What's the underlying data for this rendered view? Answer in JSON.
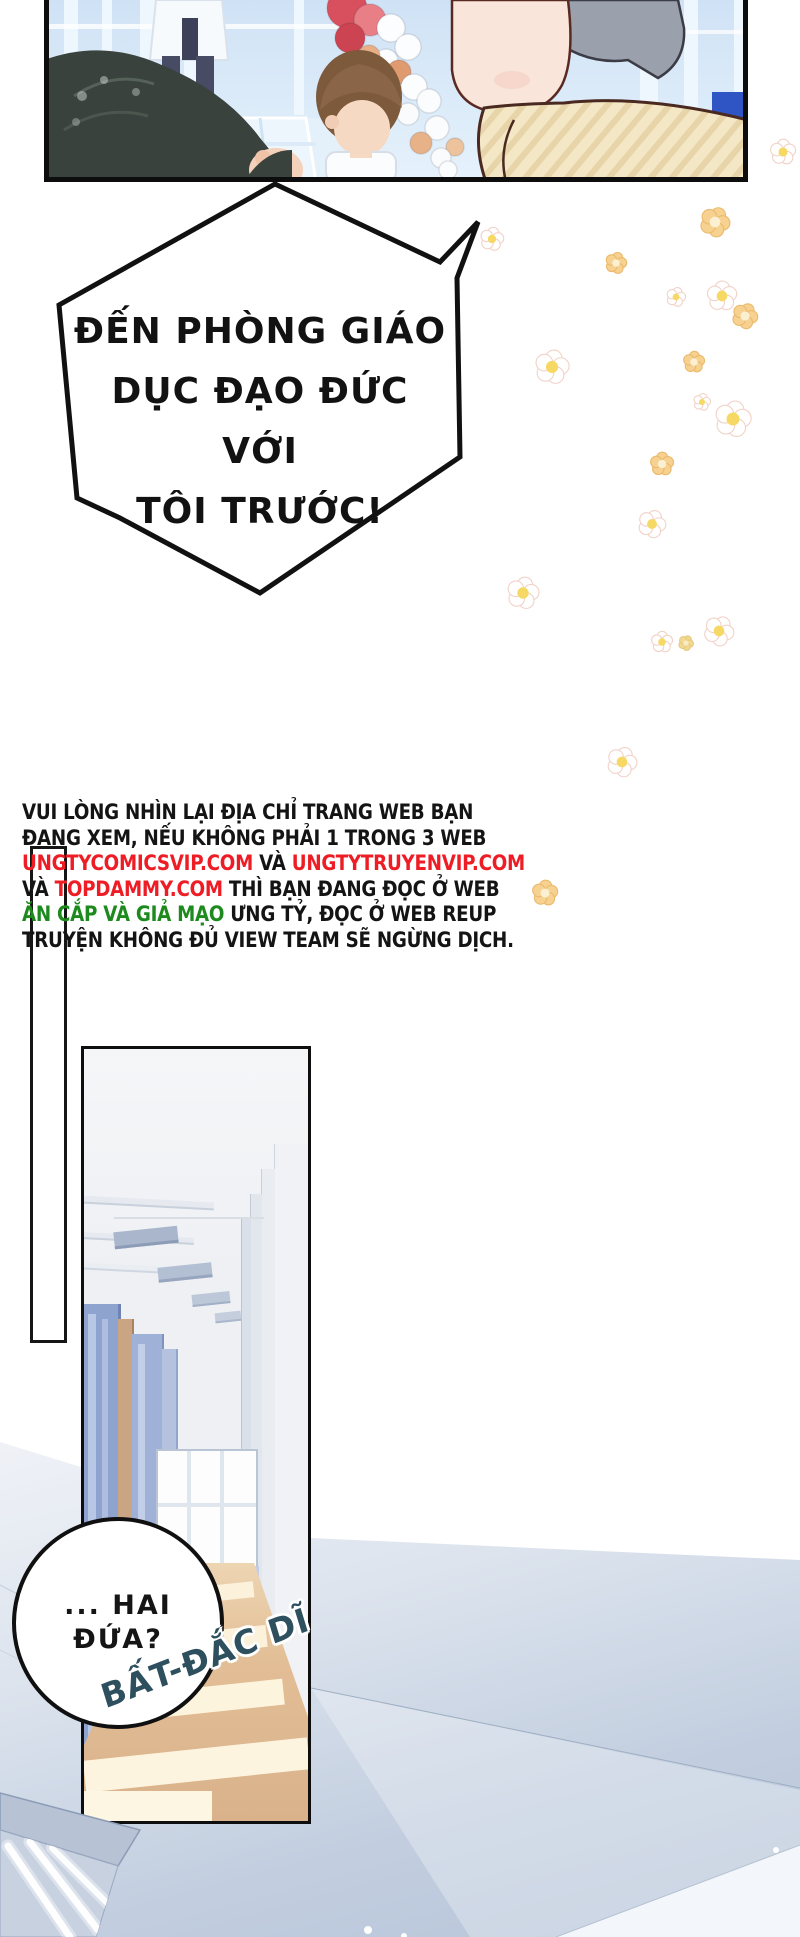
{
  "page": {
    "kind": "manhua-webtoon-page",
    "background": "#ffffff"
  },
  "top_panel": {
    "scene": "school hall interior with balloon garland, teacher on podium, children watching",
    "colors": {
      "wall_blue": "#d7e7f7",
      "platform": "#ecf5fc",
      "coat": "#f7fafc",
      "pants": "#474b63",
      "child_hair": "#7d5a3c",
      "skin": "#f6d9c3",
      "big_face": "#f9e5da",
      "big_hair": "#9aa1ad",
      "shirt": "#f4e7c6",
      "shirt_stripe": "#e7d4a8",
      "dark_hair": "#39423c",
      "blue_board": "#2f55c4"
    },
    "balloons": [
      [
        347,
        8,
        20,
        "#d8505e"
      ],
      [
        370,
        20,
        16,
        "#e87e86"
      ],
      [
        350,
        38,
        15,
        "#cc4351"
      ],
      [
        391,
        28,
        14,
        "#fcfdfe"
      ],
      [
        408,
        47,
        13,
        "#fcfdfe"
      ],
      [
        386,
        61,
        12,
        "#fafcfd"
      ],
      [
        369,
        56,
        11,
        "#eaae86"
      ],
      [
        399,
        72,
        12,
        "#e09a70"
      ],
      [
        414,
        87,
        13,
        "#fcfdfe"
      ],
      [
        429,
        101,
        12,
        "#fafcfd"
      ],
      [
        408,
        114,
        11,
        "#f9fbfc"
      ],
      [
        437,
        128,
        12,
        "#fbfcfe"
      ],
      [
        421,
        143,
        11,
        "#e8b288"
      ],
      [
        455,
        147,
        9,
        "#ecc39c"
      ],
      [
        441,
        158,
        10,
        "#fafbfd"
      ],
      [
        448,
        170,
        9,
        "#fbfcfe"
      ]
    ]
  },
  "speech_bubble": {
    "lines": [
      "ĐẾN PHÒNG GIÁO",
      "DỤC ĐẠO ĐỨC VỚI",
      "TÔI TRƯỚC!"
    ],
    "text_color": "#121212",
    "outline_color": "#111111",
    "points": "275,184 440,262 478,222 457,278 460,457 260,593 120,518 77,498 59,305"
  },
  "notice": {
    "colors": {
      "ink": "#141414",
      "red": "#ee1c25",
      "green": "#1d8a1d"
    },
    "lines": [
      [
        {
          "t": "VUI LÒNG NHÌN LẠI ĐỊA CHỈ TRANG WEB BẠN",
          "c": "ink"
        }
      ],
      [
        {
          "t": "ĐANG XEM, NẾU KHÔNG PHẢI 1 TRONG 3 WEB",
          "c": "ink"
        }
      ],
      [
        {
          "t": "UNGTYCOMICSVIP.COM",
          "c": "red"
        },
        {
          "t": " VÀ ",
          "c": "ink"
        },
        {
          "t": "UNGTYTRUYENVIP.COM",
          "c": "red"
        }
      ],
      [
        {
          "t": "VÀ ",
          "c": "ink"
        },
        {
          "t": "TOPDAMMY.COM",
          "c": "red"
        },
        {
          "t": " THÌ BẠN ĐANG ĐỌC Ở WEB",
          "c": "ink"
        }
      ],
      [
        {
          "t": "ĂN CẮP VÀ GIẢ MẠO",
          "c": "green"
        },
        {
          "t": " ƯNG TỶ, ĐỌC Ở WEB REUP",
          "c": "ink"
        }
      ],
      [
        {
          "t": "TRUYỆN KHÔNG ĐỦ VIEW TEAM SẼ NGỪNG DỊCH.",
          "c": "ink"
        }
      ]
    ]
  },
  "flowers": {
    "palette": {
      "white_petal": "#ffffff",
      "white_edge": "#f1d2c8",
      "white_center": "#f6d964",
      "orange_petal": "#f7d18f",
      "orange_edge": "#eaba6e",
      "orange_center": "#fbf0d2",
      "yellow_petal": "#f2d992",
      "yellow_edge": "#e6c87c",
      "yellow_center": "#f7ecc4"
    },
    "items": [
      [
        783,
        152,
        12,
        "w"
      ],
      [
        492,
        239,
        11,
        "w"
      ],
      [
        715,
        222,
        14,
        "o"
      ],
      [
        616,
        263,
        10,
        "o"
      ],
      [
        676,
        297,
        9,
        "w"
      ],
      [
        722,
        296,
        14,
        "w"
      ],
      [
        745,
        316,
        12,
        "o"
      ],
      [
        552,
        367,
        16,
        "w"
      ],
      [
        694,
        362,
        10,
        "o"
      ],
      [
        702,
        402,
        8,
        "w"
      ],
      [
        733,
        419,
        17,
        "w"
      ],
      [
        662,
        464,
        11,
        "o"
      ],
      [
        652,
        524,
        13,
        "w"
      ],
      [
        523,
        593,
        15,
        "w"
      ],
      [
        662,
        642,
        10,
        "w"
      ],
      [
        686,
        643,
        7,
        "y"
      ],
      [
        719,
        631,
        14,
        "w"
      ],
      [
        622,
        762,
        14,
        "w"
      ],
      [
        545,
        893,
        12,
        "o"
      ]
    ]
  },
  "corridor_panel": {
    "scene": "long school corridor with lockers, far window and sunlit tan floor",
    "floor_color": "#d9b28b",
    "sunlight_color": "#fcf2dc",
    "locker_blue": "#8ea4cf"
  },
  "circle_bubble": {
    "lines": [
      "... HAI",
      "ĐỨA?"
    ],
    "text_color": "#151515"
  },
  "sfx": {
    "text": "BẤT-ĐẮC DĨ",
    "color": "#2e4f5e"
  },
  "ambience": {
    "wash_top": "#f0f2f7",
    "wash_bottom": "#b6c4d9",
    "fixture_slab": "#b7c2d5",
    "fixture_front": "#c7d1e0",
    "tube": "#ffffff",
    "dots": [
      [
        368,
        1930,
        4
      ],
      [
        404,
        1936,
        3
      ],
      [
        776,
        1850,
        3
      ]
    ]
  }
}
